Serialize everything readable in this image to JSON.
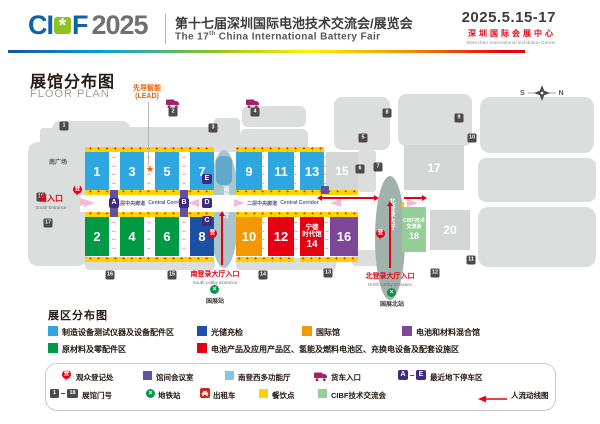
{
  "header": {
    "logo_ci": "CI",
    "logo_icon": "*",
    "logo_f": "F",
    "logo_year": "2025",
    "title_cn": "第十七届深圳国际电池技术交流会/展览会",
    "title_en_prefix": "The 17",
    "title_en_sup": "th",
    "title_en_rest": " China International Battery Fair",
    "dates": "2025.5.15-17",
    "venue_cn": "深圳国际会展中心",
    "venue_en": "Shenzhen International Exhibition Center"
  },
  "map": {
    "title_cn": "展馆分布图",
    "title_en": "FLOOR PLAN",
    "lead_line1": "先导智能",
    "lead_line2": "(LEAD)",
    "compass_s": "S",
    "compass_n": "N",
    "south_plaza": "南广场",
    "south_entrance_cn": "南入口",
    "south_entrance_en": "South Entrance",
    "corridor_cn": "二层中央廊道",
    "corridor_en": "Central Corridor",
    "south_lobby_name": "南登录大厅",
    "north_lobby_name": "北登录大厅",
    "south_lobby_entrance_cn": "南登录大厅入口",
    "south_lobby_entrance_en": "South Lobby Entrance",
    "north_lobby_entrance_cn": "北登录大厅入口",
    "north_lobby_entrance_en": "North Lobby Entrance",
    "metro_south": "国展站",
    "metro_north": "国展北站",
    "halls": [
      {
        "num": "1"
      },
      {
        "num": "3"
      },
      {
        "num": "5"
      },
      {
        "num": "7"
      },
      {
        "num": "9"
      },
      {
        "num": "11"
      },
      {
        "num": "13"
      },
      {
        "num": "15"
      },
      {
        "num": "17"
      },
      {
        "num": "2"
      },
      {
        "num": "4"
      },
      {
        "num": "6"
      },
      {
        "num": "8"
      },
      {
        "num": "10"
      },
      {
        "num": "12"
      },
      {
        "num": "14",
        "line1": "宁德",
        "line2": "时代馆"
      },
      {
        "num": "16"
      },
      {
        "num": "18",
        "line1": "CIBF技术",
        "line2": "交流会"
      },
      {
        "num": "20"
      }
    ],
    "gates": [
      "1",
      "2",
      "3",
      "4",
      "5",
      "6",
      "7",
      "8",
      "9",
      "10",
      "11",
      "12",
      "13",
      "14",
      "15",
      "16",
      "17",
      "18"
    ],
    "parking": [
      "A",
      "B",
      "C",
      "D",
      "E"
    ],
    "palette": {
      "hall_blue": "#2EA7E0",
      "hall_green": "#009944",
      "hall_dark_blue": "#1D50A2",
      "hall_orange": "#F39800",
      "hall_red": "#E60012",
      "hall_purple": "#7D4697",
      "hall_light_green": "#96CE97",
      "hall_gray": "#D4D5D5",
      "dining_yellow": "#FBD500",
      "meeting_purple": "#5F52A0",
      "parking_badge_purple": "#3F2B7E",
      "multi_hall_blue": "#7EC8EB",
      "south_lobby_teal": "#A9C6CE",
      "north_lobby_teal": "#9FB2AC",
      "accent_red": "#E60012",
      "lead_orange": "#EB6100"
    }
  },
  "zones": {
    "title": "展区分布图",
    "items": [
      {
        "color": "#2EA7E0",
        "label": "制造设备测试仪器及设备配件区"
      },
      {
        "color": "#1D50A2",
        "label": "光储充检"
      },
      {
        "color": "#F39800",
        "label": "国际馆"
      },
      {
        "color": "#7D4697",
        "label": "电池和材料混合馆"
      },
      {
        "color": "#009944",
        "label": "原材料及零配件区"
      },
      {
        "color": "#E60012",
        "label": "电池产品及应用产品区、氢能及燃料电池区、充换电设备及配套设施区"
      }
    ]
  },
  "symbols": {
    "reg_glyph": "登",
    "registration": "观众登记处",
    "meeting_room": "馆间会议室",
    "multi_hall": "南登西多功能厅",
    "truck_entrance": "货车入口",
    "parking_a": "A",
    "parking_e": "E",
    "parking_label": "最近地下停车区",
    "gate_first": "1",
    "gate_last": "18",
    "gate_label": "展馆门号",
    "metro": "地铁站",
    "metro_glyph": "×",
    "taxi": "出租车",
    "dining": "餐饮点",
    "cibf_forum": "CIBF技术交流会",
    "flow": "人流动线图",
    "dash": "–"
  },
  "decor": {
    "star": "★",
    "harrows": "↔\n↔\n↔\n↔",
    "plus_row": "+ + + + + + + + + + + + + + + + + + + + + + + + + +"
  }
}
